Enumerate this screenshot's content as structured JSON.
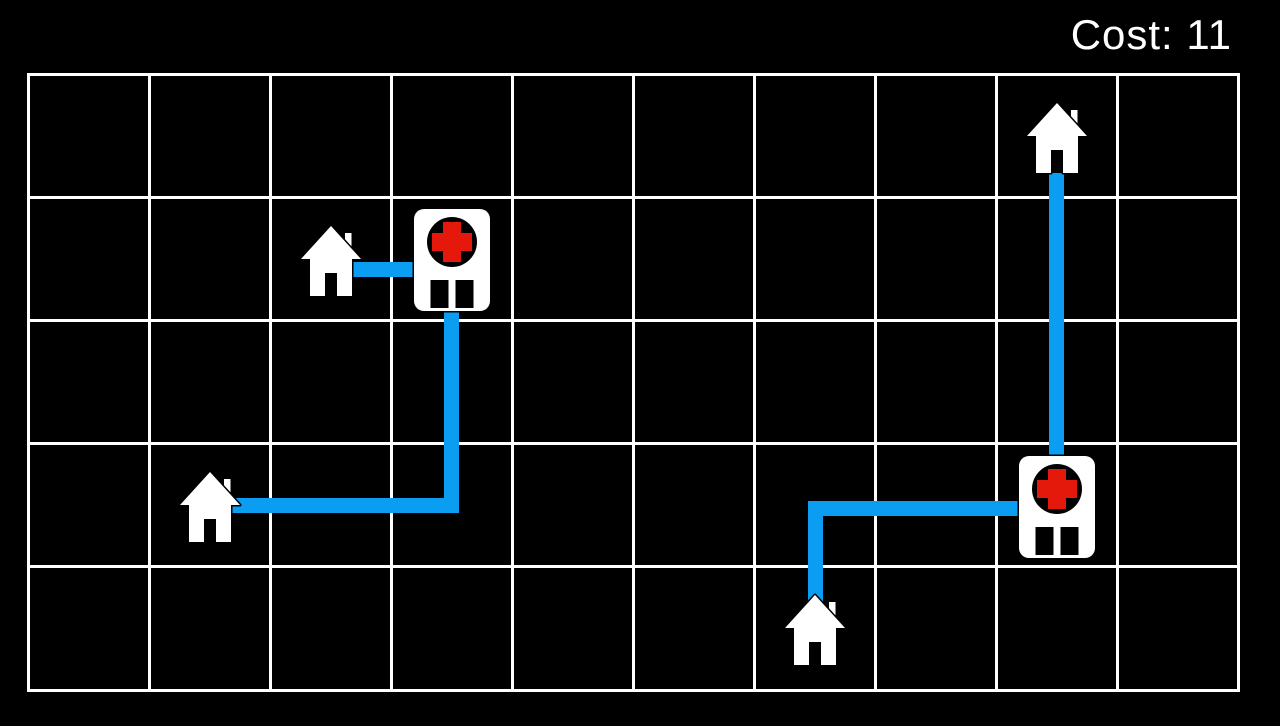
{
  "hud": {
    "cost_text": "Cost: 11"
  },
  "colors": {
    "background": "#000000",
    "grid_line": "#ffffff",
    "path_blue": "#0a9df2",
    "cross_red": "#e4190c",
    "icon_white": "#ffffff",
    "text_white": "#ffffff"
  },
  "board": {
    "rows": 5,
    "cols": 10,
    "origin_x": 28,
    "origin_y": 74,
    "cell_w": 121,
    "cell_h": 123.2,
    "line_width": 3,
    "house": {
      "w": 60,
      "h": 70,
      "dy": 2
    },
    "hospital": {
      "w": 76,
      "h": 102,
      "dy": 1.5
    }
  },
  "entities": [
    {
      "type": "house",
      "row": 0,
      "col": 8
    },
    {
      "type": "house",
      "row": 1,
      "col": 2
    },
    {
      "type": "hospital",
      "row": 1,
      "col": 3
    },
    {
      "type": "house",
      "row": 3,
      "col": 1
    },
    {
      "type": "hospital",
      "row": 3,
      "col": 8
    },
    {
      "type": "house",
      "row": 4,
      "col": 6
    }
  ],
  "paths": [
    {
      "name": "house12-to-hospital13",
      "x": 344,
      "y": 262,
      "w": 74,
      "h": 15
    },
    {
      "name": "house31-horizontal",
      "x": 218,
      "y": 498,
      "w": 241,
      "h": 15
    },
    {
      "name": "house31-vertical-to-hospital",
      "x": 444,
      "y": 310,
      "w": 15,
      "h": 203
    },
    {
      "name": "house08-vertical-to-hospital",
      "x": 1049,
      "y": 173,
      "w": 15,
      "h": 287
    },
    {
      "name": "house46-vertical",
      "x": 808,
      "y": 501,
      "w": 15,
      "h": 110
    },
    {
      "name": "house46-horizontal-to-hospital",
      "x": 808,
      "y": 501,
      "w": 213,
      "h": 15
    }
  ]
}
